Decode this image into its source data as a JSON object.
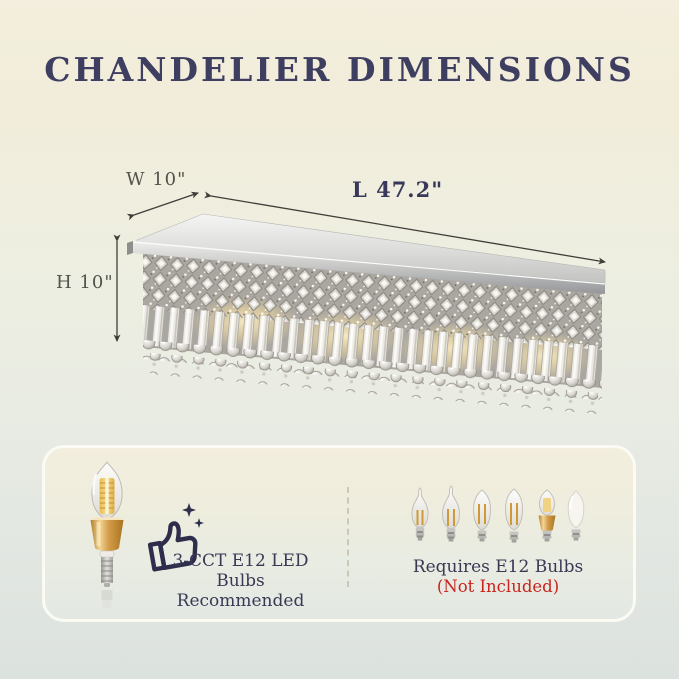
{
  "title": "CHANDELIER DIMENSIONS",
  "dimensions": {
    "width": "W 10\"",
    "length": "L 47.2\"",
    "height": "H 10\""
  },
  "recommendation": {
    "line1": "3-CCT E12 LED",
    "line2": "Bulbs Recommended"
  },
  "requirement": {
    "line1": "Requires E12 Bulbs",
    "line2": "(Not Included)"
  },
  "icons": {
    "thumbs_up": "thumbs-up-with-sparkles-icon",
    "recommended_bulb": "gold-base-e12-led-bulb-icon",
    "bulb_row": [
      "flame-tip-filament-bulb-icon",
      "flame-tip-filament-bulb-icon",
      "torpedo-filament-bulb-icon",
      "torpedo-filament-bulb-icon",
      "gold-base-led-bulb-icon",
      "frosted-torpedo-bulb-icon"
    ]
  },
  "colors": {
    "background_top": "#f3eedd",
    "background_bottom": "#dce2de",
    "title_navy": "#3e3e60",
    "text_navy": "#393954",
    "accent_red": "#c8241c",
    "dimension_gray": "#53524c",
    "gold": "#d39c4a",
    "chrome": "#c7c8c6",
    "box_border": "#fbfbf4"
  }
}
